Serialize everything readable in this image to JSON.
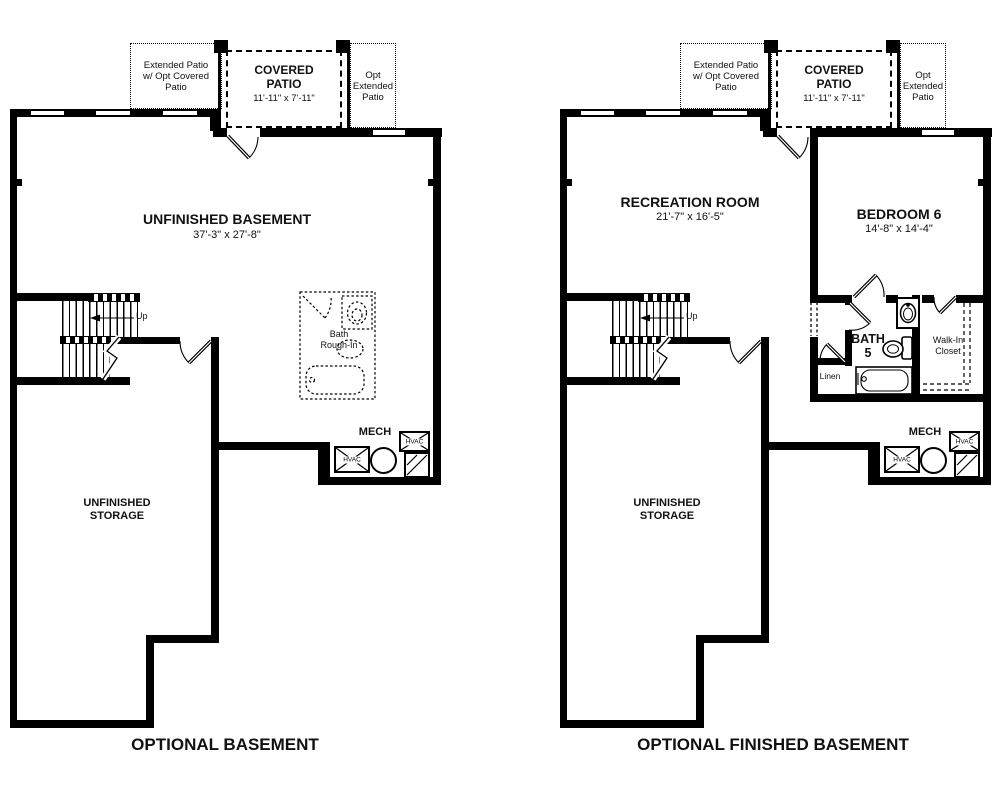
{
  "captions": {
    "left": "OPTIONAL BASEMENT",
    "right": "OPTIONAL FINISHED BASEMENT"
  },
  "patio": {
    "extended_lines": [
      "Extended Patio",
      "w/ Opt Covered",
      "Patio"
    ],
    "covered_lines": [
      "COVERED",
      "PATIO"
    ],
    "covered_dims": "11'-11\" x 7'-11\"",
    "opt_lines": [
      "Opt",
      "Extended",
      "Patio"
    ]
  },
  "stairs": {
    "up_label": "Up"
  },
  "mech": {
    "label": "MECH",
    "hvac_label": "HVAC"
  },
  "storage_lines": [
    "UNFINISHED",
    "STORAGE"
  ],
  "left_plan": {
    "room_title": "UNFINISHED BASEMENT",
    "room_dims": "37'-3\" x 27'-8\"",
    "bath_rough_in_lines": [
      "Bath",
      "Rough-In"
    ]
  },
  "right_plan": {
    "rec_room_title": "RECREATION ROOM",
    "rec_room_dims": "21'-7\" x 16'-5\"",
    "bedroom_title": "BEDROOM 6",
    "bedroom_dims": "14'-8\" x 14'-4\"",
    "bath_lines": [
      "BATH",
      "5"
    ],
    "walk_in_closet_lines": [
      "Walk-In",
      "Closet"
    ],
    "linen_label": "Linen"
  },
  "colors": {
    "wall": "#000000",
    "background": "#ffffff"
  }
}
